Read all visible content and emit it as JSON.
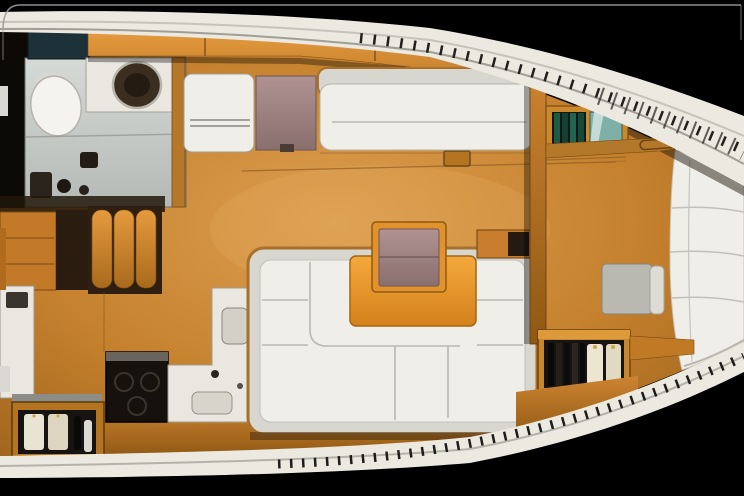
{
  "image": {
    "title": "Sailing yacht interior layout — top-down cutaway render, bow to the right",
    "visible_text": "none",
    "background": "#000000",
    "colors": {
      "deck_white": "#ece9e1",
      "floor_wood": "#c5812d",
      "furniture_wood": "#d2872e",
      "upholstery": "#efeee8",
      "upholstery_shade": "#d7d6cf",
      "table_top": "#ef9c30",
      "chart_table_mauve": "#a08585",
      "head_floor": "#ccd2cf",
      "counter_white": "#eae7e0",
      "appliance_dark": "#16110c",
      "teal_counter": "#1d3138",
      "glass_teal": "#7fb0a8",
      "wardrobe_interior": "#171310"
    },
    "regions": {
      "aft_head": "aft heads compartment with toilet, washbasin and shower",
      "companionway": "companionway steps",
      "galley": "L-shaped galley with stove, sinks and bottle locker",
      "saloon": "saloon with U-shaped settee, folding table and straight settee",
      "nav_station": "chart table and navigator seat",
      "forward_cabin": "forward cabin with V-berth, stool and open wardrobe",
      "side_decks": "white side decks with tread marks",
      "bow": "bow at right edge"
    }
  }
}
